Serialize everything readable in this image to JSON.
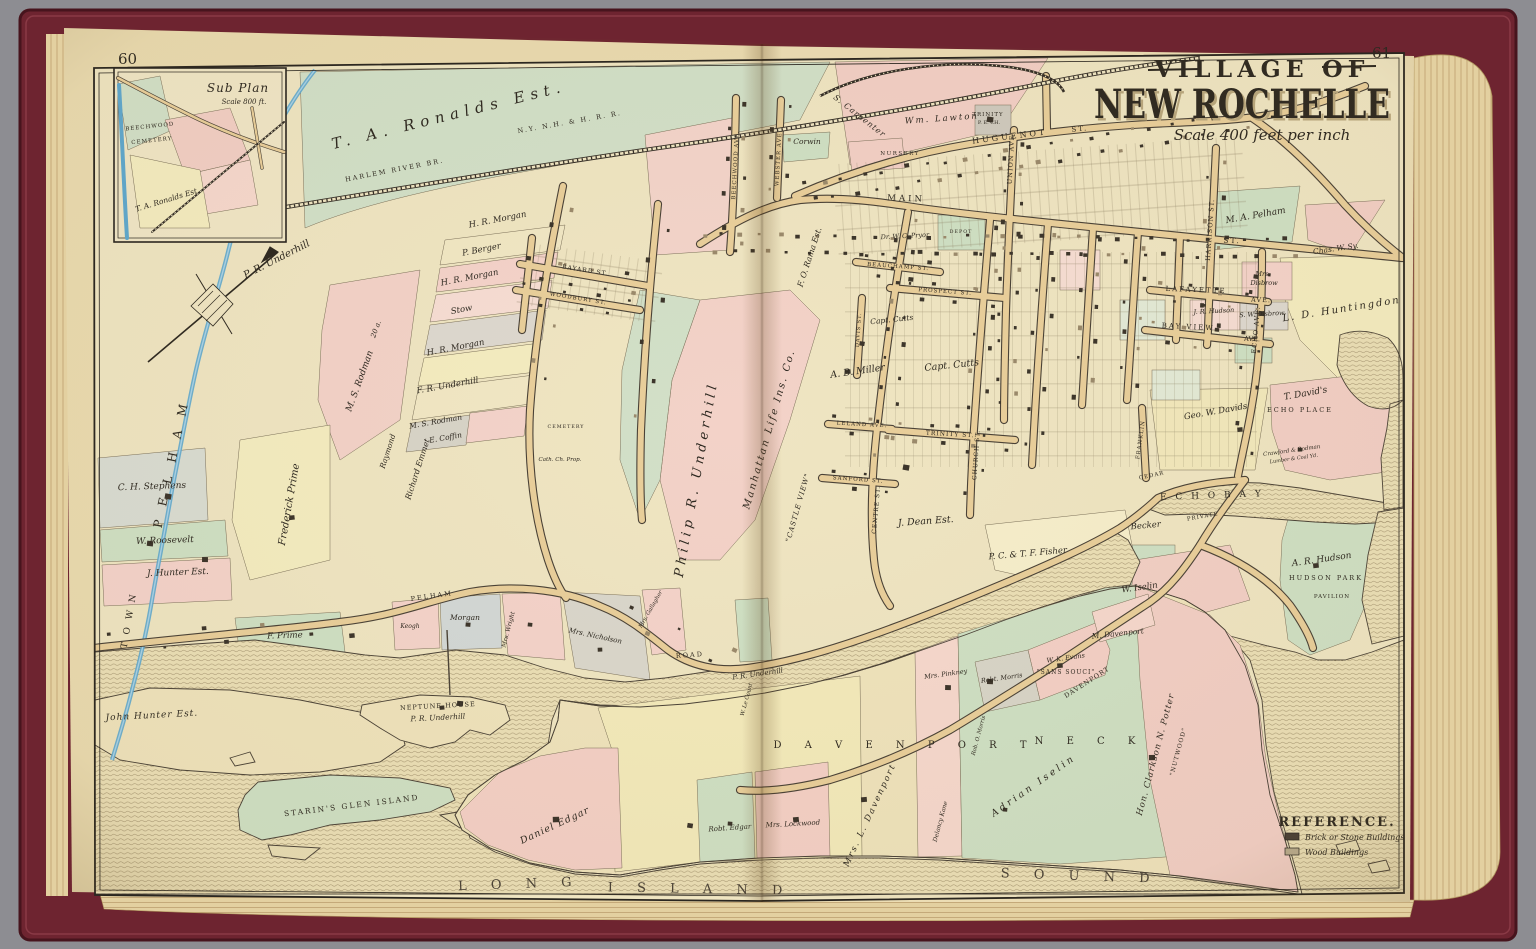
{
  "pages": {
    "left": "60",
    "right": "61"
  },
  "title": {
    "kicker": "VILLAGE OF",
    "main": "NEW ROCHELLE",
    "scale": "Scale 400 feet per inch"
  },
  "inset": {
    "title": "Sub Plan",
    "scale": "Scale 800 ft."
  },
  "legend": {
    "title": "REFERENCE.",
    "items": [
      {
        "label": "Brick or Stone Buildings",
        "color": "#4a4036"
      },
      {
        "label": "Wood Buildings",
        "color": "#b9ac8e"
      }
    ]
  },
  "credit": "© Cartography Associates, David Rumsey Collection",
  "colors": {
    "page": "#eadbb0",
    "map_base": "#efe5c2",
    "road": "#e9cf9b",
    "ink": "#2e2921",
    "water_hatch": "#8d7c5a",
    "stream": "#5fa8ce",
    "parcel_pink": "#f2cfc5",
    "parcel_green": "#cfe0c4",
    "parcel_yellow": "#f3eabb",
    "cover": "#6e2430"
  },
  "map_labels": [
    {
      "t": "T. A. Ronalds Est.",
      "x": 450,
      "y": 120,
      "s": 15,
      "r": -14,
      "ls": 6,
      "i": 1
    },
    {
      "t": "HARLEM RIVER BR.",
      "x": 395,
      "y": 172,
      "s": 6.5,
      "r": -11,
      "ls": 2
    },
    {
      "t": "N.Y. N.H. & H. R. R.",
      "x": 570,
      "y": 124,
      "s": 6.5,
      "r": -10,
      "ls": 2
    },
    {
      "t": "P. R. Underhill",
      "x": 278,
      "y": 262,
      "s": 10,
      "r": -27,
      "i": 1
    },
    {
      "t": "PELHAM",
      "x": 176,
      "y": 460,
      "s": 12,
      "r": -78,
      "ls": 14
    },
    {
      "t": "TOWN",
      "x": 132,
      "y": 618,
      "s": 9,
      "r": -80,
      "ls": 8
    },
    {
      "t": "M. S. Rodman",
      "x": 362,
      "y": 382,
      "s": 9,
      "r": -70,
      "i": 1
    },
    {
      "t": "20 a.",
      "x": 378,
      "y": 330,
      "s": 7,
      "r": -70,
      "i": 1
    },
    {
      "t": "Frederick Prime",
      "x": 292,
      "y": 505,
      "s": 10,
      "r": -80,
      "i": 1
    },
    {
      "t": "H. R. Morgan",
      "x": 498,
      "y": 222,
      "s": 8.5,
      "r": -11,
      "i": 1
    },
    {
      "t": "P. Berger",
      "x": 482,
      "y": 252,
      "s": 8.5,
      "r": -11,
      "i": 1
    },
    {
      "t": "H. R. Morgan",
      "x": 470,
      "y": 280,
      "s": 8.5,
      "r": -11,
      "i": 1
    },
    {
      "t": "Stow",
      "x": 462,
      "y": 312,
      "s": 8.5,
      "r": -11,
      "i": 1
    },
    {
      "t": "H. R. Morgan",
      "x": 456,
      "y": 350,
      "s": 8.5,
      "r": -11,
      "i": 1
    },
    {
      "t": "F. R. Underhill",
      "x": 448,
      "y": 388,
      "s": 8.5,
      "r": -10,
      "i": 1
    },
    {
      "t": "M. S. Rodman",
      "x": 436,
      "y": 424,
      "s": 7.5,
      "r": -10,
      "i": 1
    },
    {
      "t": "E. Coffin",
      "x": 446,
      "y": 440,
      "s": 7.5,
      "r": -10,
      "i": 1
    },
    {
      "t": "Richard Emmet",
      "x": 420,
      "y": 470,
      "s": 8,
      "r": -72,
      "i": 1
    },
    {
      "t": "Raymond",
      "x": 390,
      "y": 452,
      "s": 7.5,
      "r": -72,
      "i": 1
    },
    {
      "t": "Philip  R.  Underhill",
      "x": 700,
      "y": 480,
      "s": 13,
      "r": -80,
      "ls": 4,
      "i": 1
    },
    {
      "t": "Manhattan  Life  Ins.  Co.",
      "x": 772,
      "y": 430,
      "s": 10,
      "r": -74,
      "ls": 2,
      "i": 1
    },
    {
      "t": "\"CASTLE VIEW\"",
      "x": 800,
      "y": 508,
      "s": 7,
      "r": -74,
      "ls": 1,
      "i": 1
    },
    {
      "t": "F. O. Rama Est.",
      "x": 812,
      "y": 258,
      "s": 8,
      "r": -72,
      "i": 1
    },
    {
      "t": "A. B. Miller",
      "x": 858,
      "y": 374,
      "s": 9.5,
      "r": -8,
      "i": 1
    },
    {
      "t": "Capt. Cutts",
      "x": 892,
      "y": 322,
      "s": 7.5,
      "r": -6,
      "i": 1
    },
    {
      "t": "Capt. Cutts",
      "x": 952,
      "y": 368,
      "s": 9.5,
      "r": -6,
      "i": 1
    },
    {
      "t": "J. Dean Est.",
      "x": 926,
      "y": 524,
      "s": 9.5,
      "r": -4,
      "i": 1
    },
    {
      "t": "P. C. & T. F. Fisher",
      "x": 1028,
      "y": 556,
      "s": 8.5,
      "r": -5,
      "i": 1
    },
    {
      "t": "Becker",
      "x": 1146,
      "y": 528,
      "s": 8.5,
      "r": -5,
      "i": 1
    },
    {
      "t": "W. Iselin",
      "x": 1140,
      "y": 590,
      "s": 8.5,
      "r": -8,
      "i": 1
    },
    {
      "t": "M. Davenport",
      "x": 1118,
      "y": 636,
      "s": 7.5,
      "r": -6,
      "i": 1
    },
    {
      "t": "A. R. Hudson",
      "x": 1322,
      "y": 562,
      "s": 9,
      "r": -8,
      "i": 1
    },
    {
      "t": "HUDSON PARK",
      "x": 1326,
      "y": 580,
      "s": 6.5,
      "ls": 2
    },
    {
      "t": "PAVILION",
      "x": 1332,
      "y": 598,
      "s": 5.5,
      "ls": 1
    },
    {
      "t": "E C H O    B A Y",
      "x": 1212,
      "y": 498,
      "s": 9,
      "r": -2,
      "ls": 3
    },
    {
      "t": "T. David's",
      "x": 1306,
      "y": 396,
      "s": 9,
      "r": -10,
      "i": 1
    },
    {
      "t": "ECHO PLACE",
      "x": 1300,
      "y": 412,
      "s": 6.5,
      "ls": 2
    },
    {
      "t": "Geo. W. Davids",
      "x": 1216,
      "y": 414,
      "s": 8.5,
      "r": -10,
      "i": 1
    },
    {
      "t": "Crawford & Rodman",
      "x": 1292,
      "y": 452,
      "s": 5.5,
      "r": -8,
      "i": 1
    },
    {
      "t": "Lumber & Coal Yd.",
      "x": 1294,
      "y": 460,
      "s": 5,
      "r": -8,
      "i": 1
    },
    {
      "t": "L. D. Huntingdon",
      "x": 1342,
      "y": 312,
      "s": 10,
      "r": -9,
      "ls": 2,
      "i": 1
    },
    {
      "t": "Chas. W. Sy.",
      "x": 1336,
      "y": 251,
      "s": 7.5,
      "r": -8,
      "i": 1
    },
    {
      "t": "M. A. Pelham",
      "x": 1256,
      "y": 218,
      "s": 9,
      "r": -10,
      "i": 1
    },
    {
      "t": "Mrs.",
      "x": 1263,
      "y": 276,
      "s": 6.5,
      "i": 1
    },
    {
      "t": "Disbrow",
      "x": 1264,
      "y": 285,
      "s": 6.5,
      "i": 1
    },
    {
      "t": "J. R. Hudson",
      "x": 1214,
      "y": 313,
      "s": 6.5,
      "r": -3,
      "i": 1
    },
    {
      "t": "S. W. Disbrow",
      "x": 1262,
      "y": 316,
      "s": 6.5,
      "r": -3,
      "i": 1
    },
    {
      "t": "LAFAYETTE",
      "x": 1196,
      "y": 292,
      "s": 7,
      "ls": 2,
      "r": 2
    },
    {
      "t": "AVE.",
      "x": 1261,
      "y": 302,
      "s": 6.5,
      "ls": 1,
      "r": 2
    },
    {
      "t": "BAY VIEW",
      "x": 1188,
      "y": 329,
      "s": 7,
      "ls": 2,
      "r": 3
    },
    {
      "t": "AVE.",
      "x": 1252,
      "y": 341,
      "s": 6.5,
      "r": 3
    },
    {
      "t": "HARRISON  ST.",
      "x": 1212,
      "y": 230,
      "s": 6.5,
      "r": -86,
      "ls": 1
    },
    {
      "t": "HUGUENOT",
      "x": 1010,
      "y": 139,
      "s": 8,
      "r": -7,
      "ls": 3
    },
    {
      "t": "ST.",
      "x": 1080,
      "y": 131,
      "s": 7,
      "r": -6,
      "ls": 2
    },
    {
      "t": "UNION  AVE.",
      "x": 1013,
      "y": 158,
      "s": 6.5,
      "r": -87,
      "ls": 1
    },
    {
      "t": "MAIN",
      "x": 906,
      "y": 201,
      "s": 8.5,
      "r": 2,
      "ls": 3
    },
    {
      "t": "ST.",
      "x": 1232,
      "y": 243,
      "s": 7.5,
      "r": 2,
      "ls": 2
    },
    {
      "t": "TRINITY",
      "x": 988,
      "y": 116,
      "s": 5.5,
      "ls": 1
    },
    {
      "t": "P. E. CH.",
      "x": 989,
      "y": 124,
      "s": 5
    },
    {
      "t": "Wm.  Lawton",
      "x": 942,
      "y": 121,
      "s": 8.5,
      "r": -4,
      "i": 1,
      "ls": 2
    },
    {
      "t": "S. Carpenter",
      "x": 858,
      "y": 118,
      "s": 8,
      "r": 38,
      "i": 1,
      "ls": 1
    },
    {
      "t": "NURSERY",
      "x": 900,
      "y": 155,
      "s": 5.5,
      "ls": 1.5
    },
    {
      "t": "Corwin",
      "x": 807,
      "y": 144,
      "s": 7.5,
      "i": 1
    },
    {
      "t": "BEECHWOOD  AVE.",
      "x": 737,
      "y": 165,
      "s": 5.5,
      "r": -87,
      "ls": 1
    },
    {
      "t": "WEBSTER  AVE.",
      "x": 780,
      "y": 158,
      "s": 5.5,
      "r": -87,
      "ls": 1
    },
    {
      "t": "Dr. W. C. Pryor",
      "x": 905,
      "y": 238,
      "s": 6.5,
      "r": -3,
      "i": 1
    },
    {
      "t": "BEAUCHAMP  ST.",
      "x": 898,
      "y": 268,
      "s": 5.5,
      "r": 4,
      "ls": 1
    },
    {
      "t": "PROSPECT  ST.",
      "x": 945,
      "y": 293,
      "s": 5.5,
      "r": 4,
      "ls": 1
    },
    {
      "t": "DEPOT",
      "x": 961,
      "y": 233,
      "s": 4.8,
      "ls": 1
    },
    {
      "t": "LELAND  AVE.",
      "x": 862,
      "y": 426,
      "s": 5.5,
      "r": 3,
      "ls": 1
    },
    {
      "t": "TRINITY  ST.",
      "x": 950,
      "y": 436,
      "s": 6,
      "r": 3,
      "ls": 1
    },
    {
      "t": "SANFORD  ST.",
      "x": 858,
      "y": 481,
      "s": 5.5,
      "r": 4,
      "ls": 1
    },
    {
      "t": "CENTRE  ST.",
      "x": 878,
      "y": 510,
      "s": 6,
      "r": -85,
      "ls": 1
    },
    {
      "t": "CHURCH  ST.",
      "x": 978,
      "y": 455,
      "s": 6,
      "r": -86,
      "ls": 1
    },
    {
      "t": "DAVIS  ST.",
      "x": 860,
      "y": 330,
      "s": 5,
      "r": -86,
      "ls": 1
    },
    {
      "t": "ECHO  AVE.",
      "x": 1258,
      "y": 330,
      "s": 6.5,
      "r": -85,
      "ls": 1
    },
    {
      "t": "FRANKLIN",
      "x": 1142,
      "y": 440,
      "s": 5.5,
      "r": -82,
      "ls": 1
    },
    {
      "t": "CEDAR",
      "x": 1152,
      "y": 477,
      "s": 5.5,
      "r": -12,
      "ls": 1
    },
    {
      "t": "PRIVATE",
      "x": 1203,
      "y": 518,
      "s": 5.5,
      "r": -10,
      "ls": 1
    },
    {
      "t": "BAYARD  ST.",
      "x": 585,
      "y": 272,
      "s": 6,
      "r": 9,
      "ls": 1
    },
    {
      "t": "WOODBURY  ST.",
      "x": 578,
      "y": 300,
      "s": 5.5,
      "r": 9,
      "ls": 1
    },
    {
      "t": "CEMETERY",
      "x": 566,
      "y": 428,
      "s": 4.8,
      "ls": 1
    },
    {
      "t": "Cath. Ch. Prop.",
      "x": 560,
      "y": 461,
      "s": 5.5,
      "i": 1
    },
    {
      "t": "C. H. Stephens",
      "x": 152,
      "y": 489,
      "s": 9,
      "r": -2,
      "i": 1
    },
    {
      "t": "W. Roosevelt",
      "x": 165,
      "y": 543,
      "s": 9,
      "r": -2,
      "i": 1
    },
    {
      "t": "J. Hunter Est.",
      "x": 178,
      "y": 575,
      "s": 9,
      "r": -2,
      "i": 1
    },
    {
      "t": "F. Prime",
      "x": 285,
      "y": 638,
      "s": 8.5,
      "r": -2,
      "i": 1
    },
    {
      "t": "PELHAM",
      "x": 432,
      "y": 598,
      "s": 6.5,
      "r": -8,
      "ls": 2
    },
    {
      "t": "ROAD",
      "x": 690,
      "y": 657,
      "s": 6.5,
      "r": -4,
      "ls": 2
    },
    {
      "t": "Keogh",
      "x": 410,
      "y": 628,
      "s": 6,
      "i": 1
    },
    {
      "t": "Morgan",
      "x": 465,
      "y": 620,
      "s": 7.5,
      "i": 1
    },
    {
      "t": "Mrs. Wright",
      "x": 510,
      "y": 630,
      "s": 6,
      "r": -75,
      "i": 1
    },
    {
      "t": "Mrs. Nicholson",
      "x": 595,
      "y": 638,
      "s": 7,
      "r": 12,
      "i": 1
    },
    {
      "t": "Mrs. Gallagher",
      "x": 652,
      "y": 610,
      "s": 5.5,
      "r": -60,
      "i": 1
    },
    {
      "t": "W. Le Count",
      "x": 748,
      "y": 700,
      "s": 5.5,
      "r": -75,
      "i": 1
    },
    {
      "t": "P. R. Underhill",
      "x": 758,
      "y": 676,
      "s": 7,
      "r": -8,
      "i": 1
    },
    {
      "t": "John Hunter Est.",
      "x": 152,
      "y": 718,
      "s": 9,
      "r": -3,
      "i": 1,
      "ls": 1
    },
    {
      "t": "NEPTUNE  HOUSE",
      "x": 438,
      "y": 708,
      "s": 6.5,
      "r": -3,
      "ls": 1
    },
    {
      "t": "P. R. Underhill",
      "x": 438,
      "y": 720,
      "s": 7.5,
      "r": -3,
      "i": 1
    },
    {
      "t": "STARIN'S  GLEN  ISLAND",
      "x": 352,
      "y": 808,
      "s": 7.5,
      "r": -7,
      "ls": 2
    },
    {
      "t": "Daniel Edgar",
      "x": 556,
      "y": 828,
      "s": 9.5,
      "r": -25,
      "i": 1,
      "ls": 1
    },
    {
      "t": "Robt. Edgar",
      "x": 730,
      "y": 830,
      "s": 7,
      "r": -4,
      "i": 1
    },
    {
      "t": "Mrs. Lockwood",
      "x": 793,
      "y": 826,
      "s": 7,
      "r": -3,
      "i": 1
    },
    {
      "t": "Mrs. L. Davenport",
      "x": 872,
      "y": 816,
      "s": 8.5,
      "r": -65,
      "ls": 2,
      "i": 1
    },
    {
      "t": "Delancy Kane",
      "x": 942,
      "y": 822,
      "s": 6,
      "r": -75,
      "i": 1
    },
    {
      "t": "Adrian  Iselin",
      "x": 1035,
      "y": 788,
      "s": 9.5,
      "r": -35,
      "ls": 3,
      "i": 1
    },
    {
      "t": "D A V E N P O R T",
      "x": 905,
      "y": 748,
      "s": 10,
      "ls": 10
    },
    {
      "t": "N E C K",
      "x": 1090,
      "y": 744,
      "s": 10,
      "ls": 10
    },
    {
      "t": "DAVENPORT",
      "x": 1088,
      "y": 684,
      "s": 6.5,
      "r": -33,
      "ls": 1
    },
    {
      "t": "Mrs. Pinkney",
      "x": 946,
      "y": 676,
      "s": 6.5,
      "r": -8,
      "i": 1
    },
    {
      "t": "Robt. Morris",
      "x": 1002,
      "y": 680,
      "s": 6.5,
      "r": -8,
      "i": 1
    },
    {
      "t": "W. K. Evans",
      "x": 1066,
      "y": 660,
      "s": 6.5,
      "r": -8,
      "i": 1
    },
    {
      "t": "\"SANS SOUCI\"",
      "x": 1066,
      "y": 674,
      "s": 6,
      "ls": 1
    },
    {
      "t": "Rob. O. Morris",
      "x": 980,
      "y": 736,
      "s": 5.5,
      "r": -75,
      "i": 1
    },
    {
      "t": "Hon. Clarkson N. Potter",
      "x": 1158,
      "y": 755,
      "s": 8.5,
      "r": -75,
      "ls": 1,
      "i": 1
    },
    {
      "t": "\"NUTWOOD\"",
      "x": 1180,
      "y": 752,
      "s": 6,
      "r": -75,
      "ls": 1
    },
    {
      "t": "L O N G",
      "x": 520,
      "y": 888,
      "s": 13,
      "ls": 10,
      "r": -2,
      "c": "#4a4237"
    },
    {
      "t": "I S L A N D",
      "x": 700,
      "y": 893,
      "s": 13,
      "ls": 10,
      "r": 1,
      "c": "#4a4237"
    },
    {
      "t": "S O U N D",
      "x": 1080,
      "y": 880,
      "s": 13,
      "ls": 10,
      "r": 2,
      "c": "#4a4237"
    }
  ],
  "inset_labels": [
    {
      "t": "BEECHWOOD",
      "x": 150,
      "y": 128,
      "s": 5.5,
      "ls": 1,
      "r": -6
    },
    {
      "t": "CEMETERY",
      "x": 152,
      "y": 142,
      "s": 5.5,
      "ls": 1,
      "r": -6
    },
    {
      "t": "T. A. Ronalds Est.",
      "x": 168,
      "y": 202,
      "s": 7.5,
      "r": -17,
      "i": 1
    }
  ]
}
